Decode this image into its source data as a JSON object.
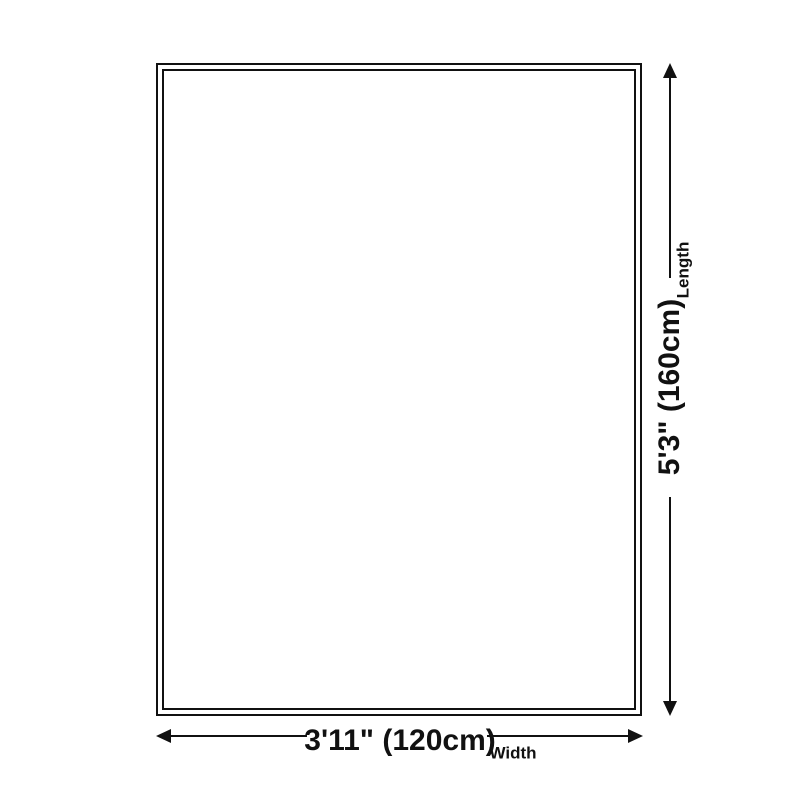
{
  "diagram": {
    "type": "product-size-diagram",
    "colors": {
      "line": "#111111",
      "background": "#ffffff"
    },
    "rug": {
      "shape": "rectangle",
      "border_style": "double"
    },
    "dimensions": {
      "length": {
        "value": "5'3\" (160cm)",
        "label": "Length"
      },
      "width": {
        "value": "3'11\" (120cm)",
        "label": "Width"
      }
    }
  }
}
